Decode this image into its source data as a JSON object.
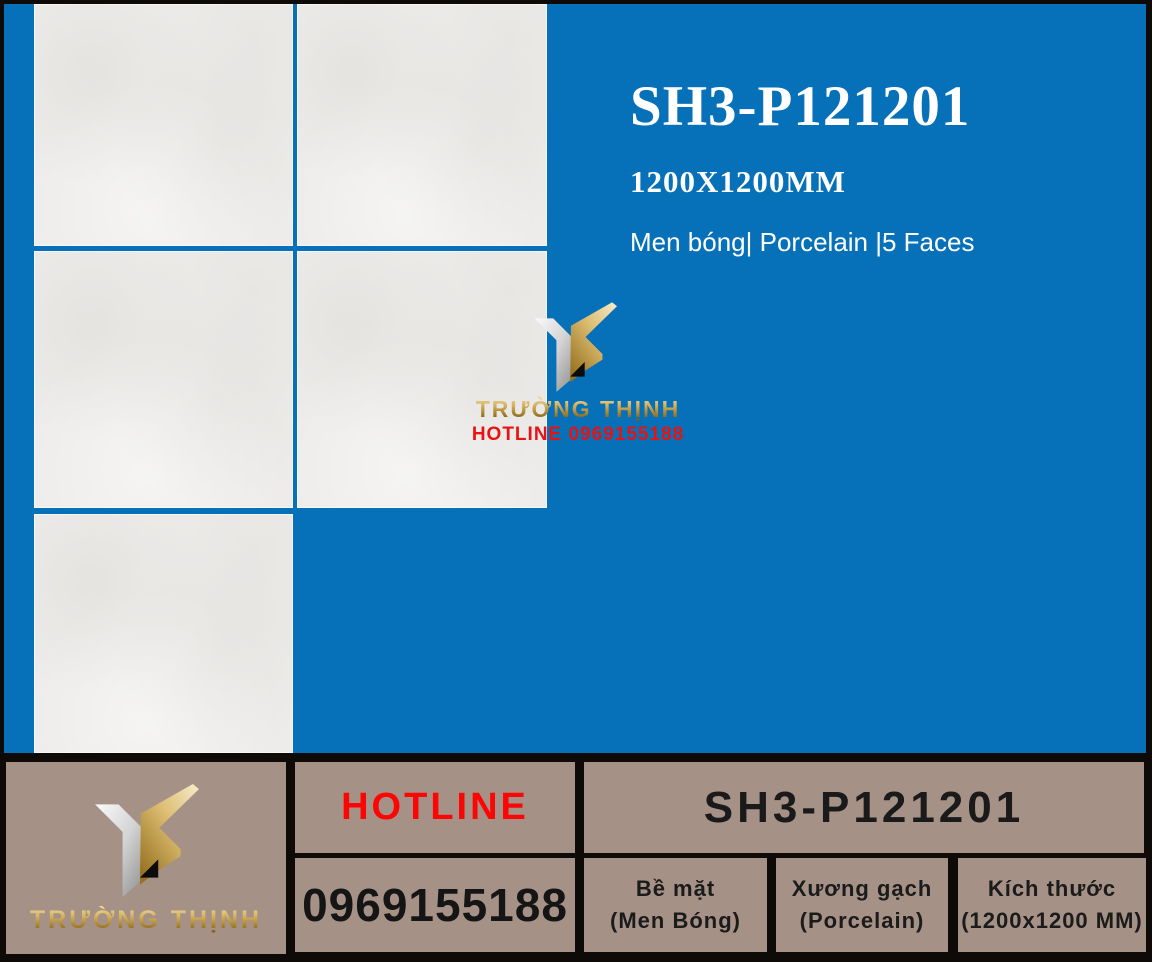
{
  "product": {
    "code": "SH3-P121201",
    "size": "1200X1200MM",
    "tagline": "Men bóng| Porcelain |5 Faces"
  },
  "overlay": {
    "brand": "TRƯỜNG THỊNH",
    "hotline": "HOTLINE 0969155188"
  },
  "table": {
    "brand": "TRƯỜNG THỊNH",
    "hotline_label": "HOTLINE",
    "phone": "0969155188",
    "code": "SH3-P121201",
    "specs": [
      {
        "label": "Bề mặt",
        "value": "(Men Bóng)"
      },
      {
        "label": "Xương gạch",
        "value": "(Porcelain)"
      },
      {
        "label": "Kích thước",
        "value": "(1200x1200 MM)"
      }
    ]
  },
  "icons": {
    "brand_logo": "truong-thinh-ribbon-y-logo"
  },
  "colors": {
    "blue": "#0671b8",
    "tile": "#edecea",
    "frame": "#0d0a07",
    "cell": "#a69186",
    "red": "#f40b0b",
    "gold": "#c8a551",
    "white": "#ffffff",
    "dark": "#1b1b1b"
  }
}
